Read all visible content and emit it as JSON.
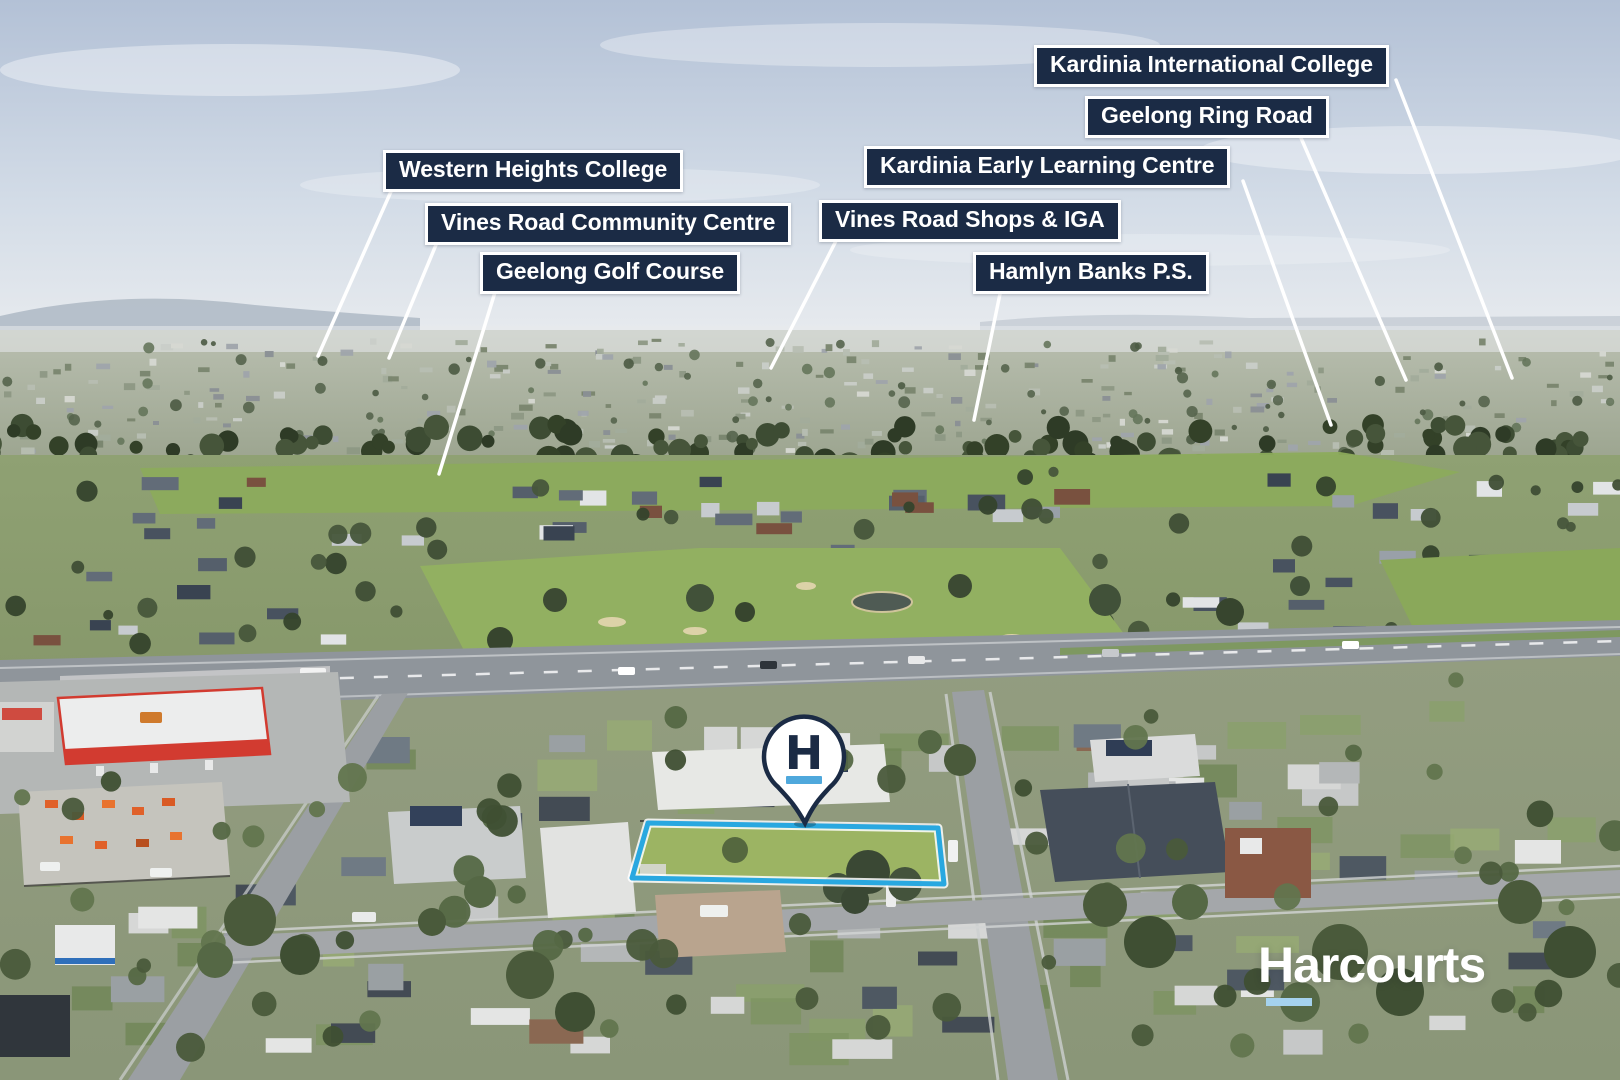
{
  "labels": [
    {
      "id": "kardinia-international-college",
      "text": "Kardinia International College"
    },
    {
      "id": "geelong-ring-road",
      "text": "Geelong Ring Road"
    },
    {
      "id": "kardinia-early-learning-centre",
      "text": "Kardinia Early Learning Centre"
    },
    {
      "id": "western-heights-college",
      "text": "Western Heights College"
    },
    {
      "id": "vines-road-shops-iga",
      "text": "Vines Road Shops & IGA"
    },
    {
      "id": "vines-road-community-centre",
      "text": "Vines Road Community Centre"
    },
    {
      "id": "geelong-golf-course",
      "text": "Geelong Golf Course"
    },
    {
      "id": "hamlyn-banks-ps",
      "text": "Hamlyn Banks P.S."
    }
  ],
  "marker": {
    "letter": "H"
  },
  "brand": {
    "wordmark": "Harcourts"
  },
  "colors": {
    "label_bg": "#1b2b45",
    "label_border": "#ffffff",
    "label_text": "#ffffff",
    "leader_line": "#ffffff",
    "boundary_blue": "#29a8e0",
    "pin_fill": "#ffffff",
    "pin_navy": "#1b2b45",
    "pin_bar_blue": "#4fa8dc",
    "wordmark": "#ffffff",
    "logo_underline": "#a5d2ee"
  }
}
